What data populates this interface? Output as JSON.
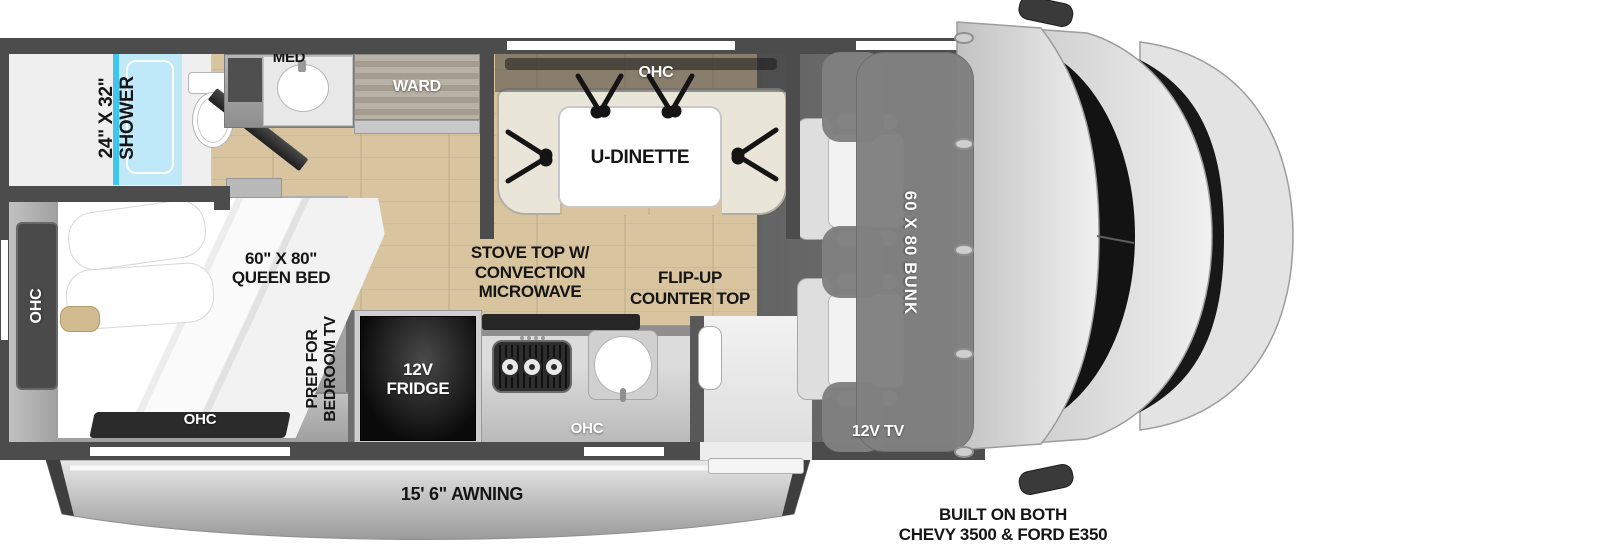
{
  "floorplan": {
    "bathroom": {
      "shower_label": "24\" X 32\"\nSHOWER",
      "med_label": "MED",
      "ward_label": "WARD"
    },
    "dinette": {
      "ohc_label": "OHC",
      "table_label": "U-DINETTE"
    },
    "kitchen": {
      "fridge_label": "12V\nFRIDGE",
      "stove_note": "STOVE TOP W/\nCONVECTION\nMICROWAVE",
      "counter_note": "FLIP-UP\nCOUNTER TOP",
      "ohc_label": "OHC"
    },
    "bedroom": {
      "bed_label": "60\" X 80\"\nQUEEN BED",
      "tv_note": "PREP FOR\nBEDROOM TV",
      "ohc_side_label": "OHC",
      "ohc_rear_label": "OHC"
    },
    "cab": {
      "bunk_label": "60 X 80 BUNK",
      "tv_label": "12V TV"
    },
    "exterior": {
      "awning_label": "15' 6\" AWNING",
      "chassis_note": "BUILT ON BOTH\nCHEVY 3500 & FORD E350"
    }
  },
  "colors": {
    "wall": "#4c4c4c",
    "wood_floor": "#d8c49e",
    "carpet": "#a2a2a2",
    "cab_floor": "#6a6a6a",
    "shower_glass": "#bfe9f8",
    "shower_glass_edge": "#3fc6ee",
    "dinette_bench": "#e9e5d9",
    "bunk_overlay": "#828282",
    "fridge": "#0a0a0a",
    "awning": "#b5b5b5",
    "windshield": "#141414",
    "cab_body": "#d9d9d9",
    "label_dark": "#151515",
    "label_light": "#ffffff"
  }
}
